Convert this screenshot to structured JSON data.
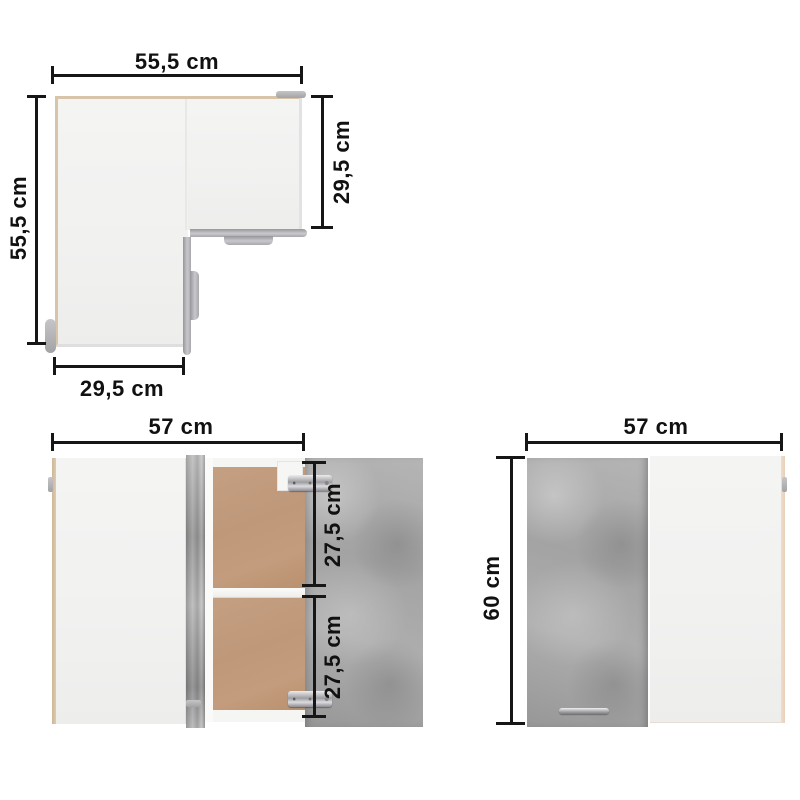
{
  "figure": {
    "top_view": {
      "width_label": "55,5 cm",
      "side_depth_label": "55,5 cm",
      "right_wing_depth_label": "29,5 cm",
      "bottom_wing_width_label": "29,5 cm"
    },
    "open_view": {
      "width_label": "57 cm",
      "upper_compartment_label": "27,5 cm",
      "lower_compartment_label": "27,5 cm"
    },
    "closed_view": {
      "width_label": "57 cm",
      "height_label": "60 cm"
    }
  },
  "colors": {
    "dimension_ink": "#161616",
    "panel_white": "#f2f2f1",
    "edge_oak": "#d7c4a9",
    "edge_oak_light": "#ecd9c6",
    "concrete_gray": "#a8a8a8",
    "interior_wood": "#c19b7c",
    "metal_silver": "#c9c9cc",
    "background": "#ffffff"
  }
}
